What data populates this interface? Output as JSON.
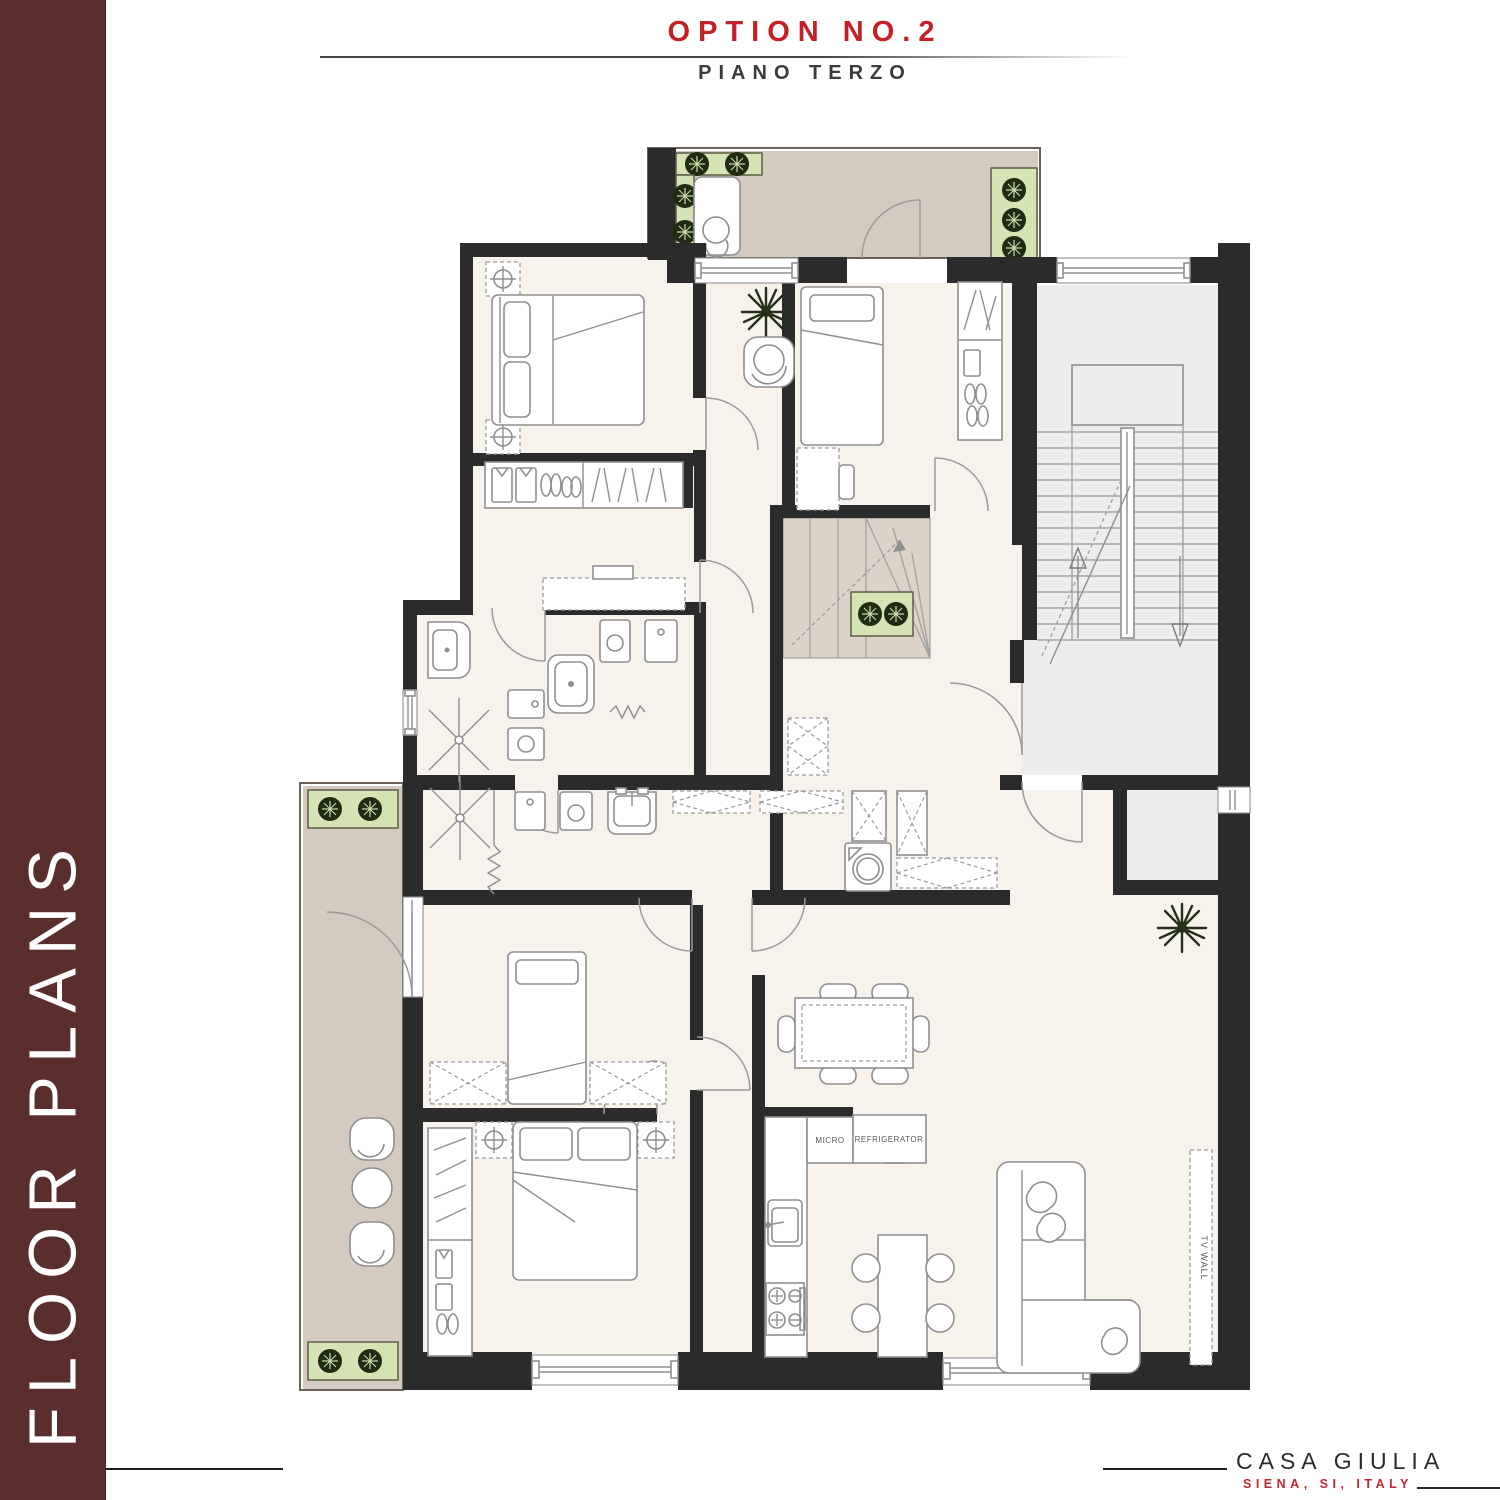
{
  "header": {
    "title": "OPTION NO.2",
    "subtitle": "PIANO TERZO"
  },
  "sidebar": {
    "label": "FLOOR PLANS"
  },
  "plan": {
    "labels": {
      "micro": "MICRO",
      "refrigerator": "REFRIGERATOR",
      "tv_wall": "TV WALL"
    }
  },
  "footer": {
    "project": "CASA GIULIA",
    "location": "SIENA, SI, ITALY"
  },
  "colors": {
    "sidebar_bg": "#5b2e2e",
    "accent_red": "#c32127",
    "subtitle_gray": "#3b3b3b",
    "wall": "#2b2b2b",
    "floor_cream": "#f8f2ed",
    "balcony_beige": "#d5cabf",
    "planter_green": "#d6e3b5",
    "stairwell_gray": "#ededed",
    "footer_red": "#c0282e"
  }
}
